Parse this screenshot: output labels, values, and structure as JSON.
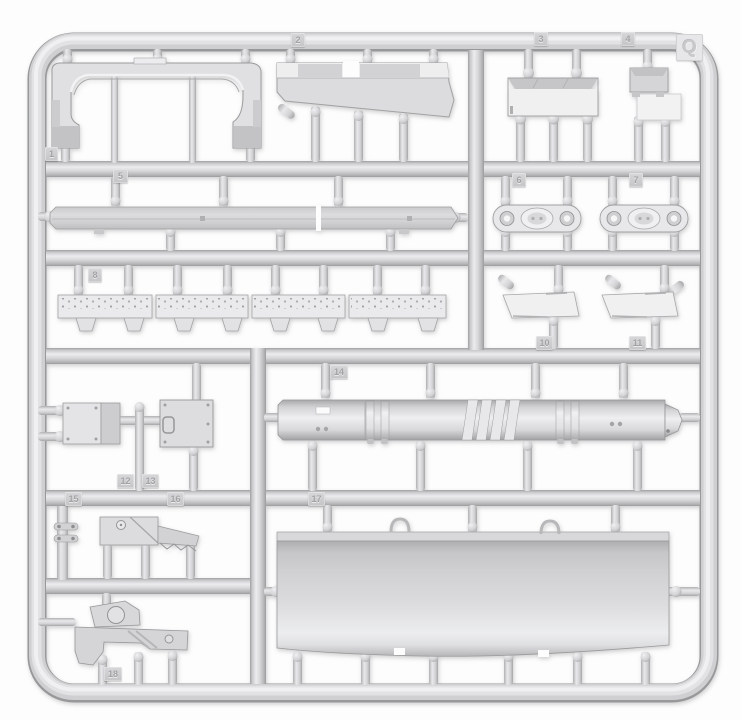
{
  "photo": {
    "description": "Light-gray injection-molded plastic model kit sprue photographed on a white background",
    "sprue_letter": "Q",
    "plastic_color": "#d4d4d6",
    "background_color": "#fdfdfd"
  },
  "tags": [
    {
      "label": "1"
    },
    {
      "label": "2"
    },
    {
      "label": "3"
    },
    {
      "label": "4"
    },
    {
      "label": "5"
    },
    {
      "label": "6"
    },
    {
      "label": "7"
    },
    {
      "label": "8"
    },
    {
      "label": "10"
    },
    {
      "label": "11"
    },
    {
      "label": "12"
    },
    {
      "label": "13"
    },
    {
      "label": "14"
    },
    {
      "label": "15"
    },
    {
      "label": "16"
    },
    {
      "label": "17"
    },
    {
      "label": "18"
    }
  ]
}
